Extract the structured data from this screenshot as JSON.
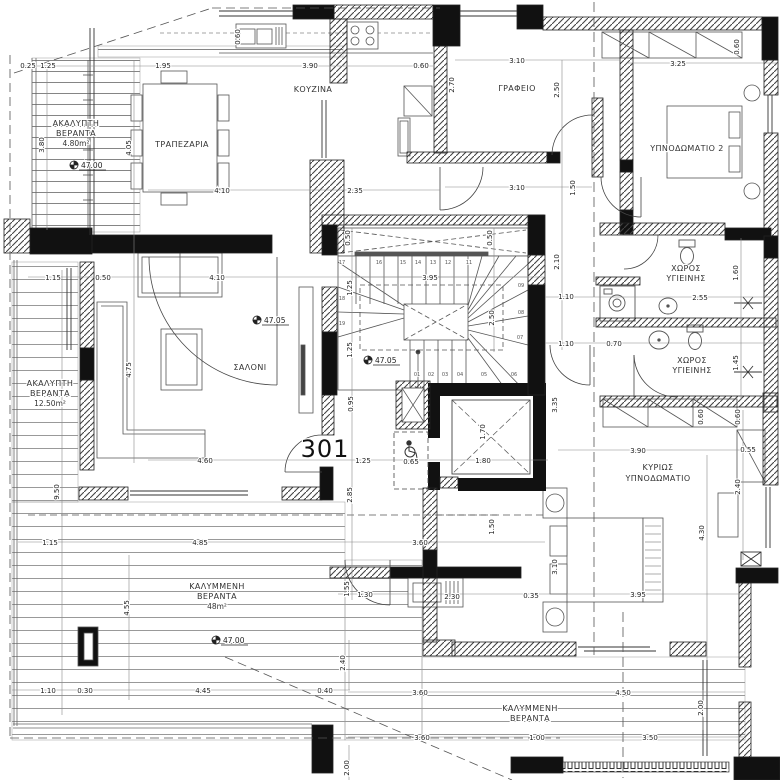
{
  "unit": {
    "number": "301"
  },
  "rooms": {
    "kitchen": "ΚΟΥΖΙΝΑ",
    "dining": "ΤΡΑΠΕΖΑΡΙΑ",
    "office": "ΓΡΑΦΕΙΟ",
    "bedroom2": "ΥΠΝΟΔΩΜΑΤΙΟ 2",
    "bath_l1": "ΧΩΡΟΣ",
    "bath_l2": "ΥΓΙΕΙΝΗΣ",
    "living": "ΣΑΛΟΝΙ",
    "master_l1": "ΚΥΡΙΩΣ",
    "master_l2": "ΥΠΝΟΔΩΜΑΤΙΟ",
    "covered_l1": "ΚΑΛΥΜΜΕΝΗ",
    "covered_l2": "ΒΕΡΑΝΤΑ",
    "covered_area": "48m²",
    "open_l1": "ΑΚΑΛΥΠΤΗ",
    "open_l2": "ΒΕΡΑΝΤΑ",
    "open1_area": "4.80m²",
    "open2_area": "12.50m²"
  },
  "levels": {
    "l4700": "47.00",
    "l4705": "47.05"
  },
  "dims": {
    "v025": "0.25",
    "v125": "1.25",
    "v195": "1.95",
    "v390": "3.90",
    "v060": "0.60",
    "v310": "3.10",
    "v325": "3.25",
    "v410": "4.10",
    "v235": "2.35",
    "v115": "1.15",
    "v050": "0.50",
    "v395": "3.95",
    "v110": "1.10",
    "v255": "2.55",
    "v070": "0.70",
    "v460": "4.60",
    "v065": "0.65",
    "v180": "1.80",
    "v055": "0.55",
    "v485": "4.85",
    "v360": "3.60",
    "v130": "1.30",
    "v230": "2.30",
    "v035": "0.35",
    "v030": "0.30",
    "v445": "4.45",
    "v040": "0.40",
    "v450": "4.50",
    "v100": "1.00",
    "v350": "3.50",
    "v380": "3.80",
    "v405": "4.05",
    "v270": "2.70",
    "v250": "2.50",
    "v150": "1.50",
    "v210": "2.10",
    "v160": "1.60",
    "v145": "1.45",
    "v170": "1.70",
    "v335": "3.35",
    "v240": "2.40",
    "v430": "4.30",
    "v285": "2.85",
    "v095": "0.95",
    "v950": "9.50",
    "v475": "4.75",
    "v455": "4.55",
    "v155": "1.55",
    "v200": "2.00"
  },
  "stairs": {
    "s01": "01",
    "s02": "02",
    "s03": "03",
    "s04": "04",
    "s05": "05",
    "s06": "06",
    "s07": "07",
    "s08": "08",
    "s09": "09",
    "s11": "11",
    "s12": "12",
    "s13": "13",
    "s14": "14",
    "s15": "15",
    "s16": "16",
    "s17": "17",
    "s18": "18",
    "s19": "19"
  }
}
